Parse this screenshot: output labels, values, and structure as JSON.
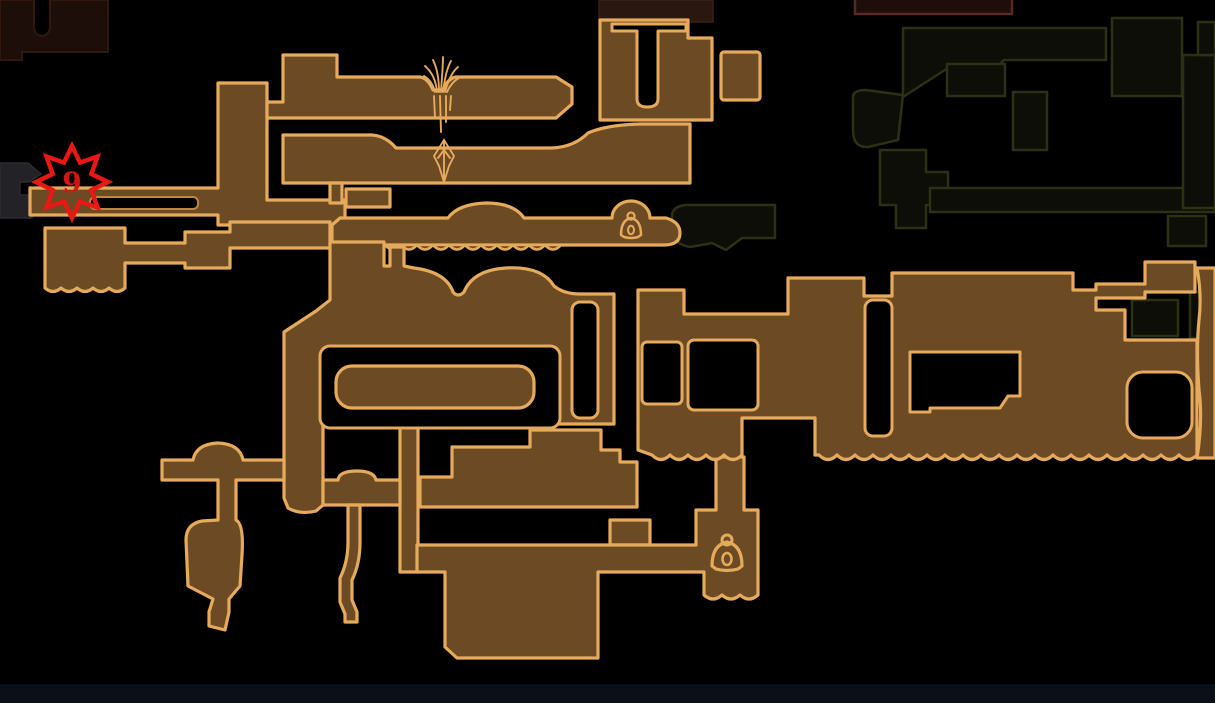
{
  "map": {
    "title": "in-game area map (explored cavern zone)",
    "palette": {
      "map_fill": "#6c4b24",
      "map_stroke": "#e5aa5c",
      "olive_fill": "#0d0e07",
      "olive_stroke": "#2d3114",
      "maroon_fill": "#1d0e09",
      "maroon_stroke": "#31180f",
      "maroon_strip_fill": "#1e0d0b",
      "maroon_strip_stroke": "#572a24",
      "cap_fill": "#2a1710",
      "charcoal_fill": "#232226",
      "slot_stroke": "#bb8749",
      "pin_red": "#e81812",
      "pin_number": "#d41410",
      "bottom_strip": "#0b0f18"
    },
    "marker": {
      "type": "star-pin",
      "label": "9",
      "x": 72,
      "y": 182
    },
    "icons": [
      {
        "name": "bell-icon",
        "x": 631,
        "y": 228,
        "size": "small"
      },
      {
        "name": "bell-icon",
        "x": 727,
        "y": 557,
        "size": "large"
      }
    ],
    "decorations": [
      "grass-tufts",
      "hanging-spikes",
      "crystal-stalactite",
      "scalloped-cavern-edges"
    ],
    "regions": [
      {
        "name": "explored-brown-complex",
        "state": "explored"
      },
      {
        "name": "top-right-olive-maze",
        "state": "unexplored"
      },
      {
        "name": "top-left-maroon-zone",
        "state": "unexplored"
      },
      {
        "name": "left-charcoal-passage",
        "state": "unexplored"
      }
    ]
  }
}
